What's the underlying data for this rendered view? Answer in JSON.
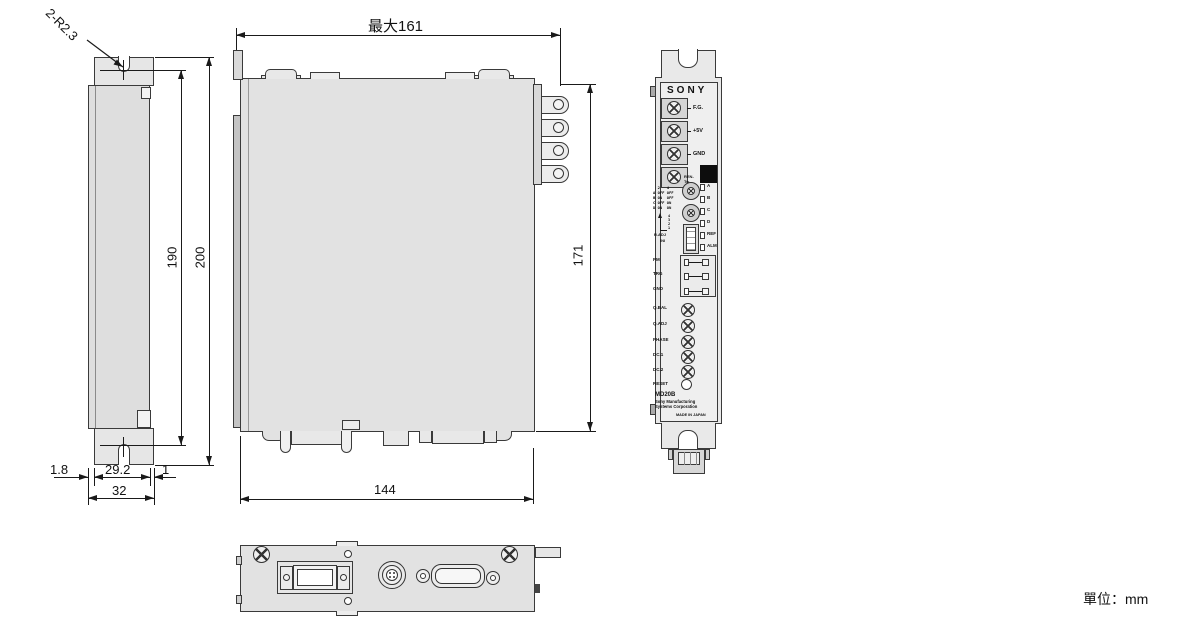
{
  "unit_label": "單位：mm",
  "dims": {
    "corner_note": "2-R2.3",
    "max_width": "最大161",
    "inner_height": "190",
    "overall_height": "200",
    "left_offset": "1.8",
    "flange_width": "29.2",
    "right_offset": "1",
    "side_depth": "32",
    "right_height": "171",
    "bottom_width": "144"
  },
  "front_panel": {
    "brand": "SONY",
    "terminal_labels": [
      "F.G.",
      "+5V",
      "GND"
    ],
    "mini_label": "REN-Tw",
    "led_labels": [
      "A",
      "B",
      "C",
      "D",
      "REF",
      "ALM"
    ],
    "dip_table": [
      "  2   4",
      "A OFF OFF",
      "B ON  OFF",
      "C OFF ON",
      "D ON  ON"
    ],
    "rotary_numbers": "4\n3\n2\n1",
    "rotary_labels": [
      "R.ADJ",
      "INI"
    ],
    "check_pin_labels": [
      "PM",
      "TRG",
      "GND"
    ],
    "adjuster_labels": [
      "Q.BAL",
      "Q.ADJ",
      "PHASE",
      "DC.1",
      "DC.2"
    ],
    "reset_label": "RESET",
    "model": "MD20B",
    "maker_line1": "Sony Manufacturing",
    "maker_line2": "Systems Corporation",
    "made_in": "MADE IN JAPAN"
  }
}
